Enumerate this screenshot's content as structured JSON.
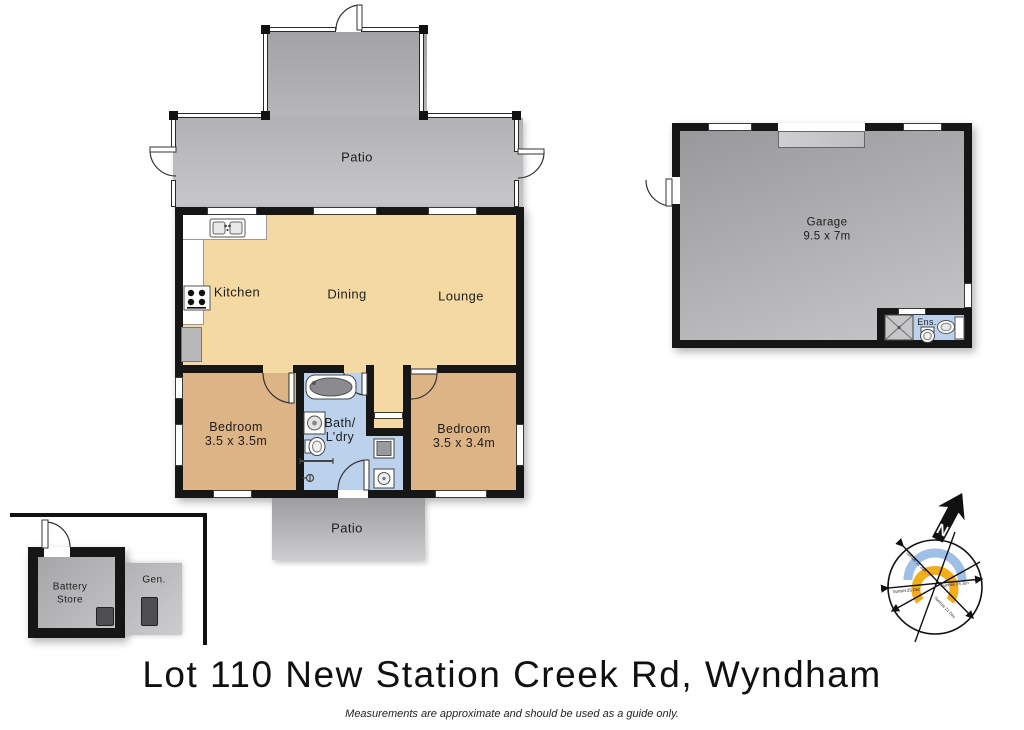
{
  "title": "Lot 110 New Station Creek Rd, Wyndham",
  "disclaimer": "Measurements are approximate and should be used as a guide only.",
  "house": {
    "patio_top": "Patio",
    "patio_bottom": "Patio",
    "kitchen": "Kitchen",
    "dining": "Dining",
    "lounge": "Lounge",
    "bedroom1_name": "Bedroom",
    "bedroom1_dims": "3.5 x 3.5m",
    "bedroom2_name": "Bedroom",
    "bedroom2_dims": "3.5 x 3.4m",
    "bath_line1": "Bath/",
    "bath_line2": "L’dry"
  },
  "garage": {
    "name": "Garage",
    "dims": "9.5 x 7m",
    "ensuite_label": "Ens."
  },
  "outbuildings": {
    "battery_store_line1": "Battery",
    "battery_store_line2": "Store",
    "generator_label": "Gen."
  },
  "compass": {
    "north_label": "N",
    "sunset_dec": "Sunset 25 Dec",
    "sunrise_jun": "Sunrise 25 Jun",
    "sunset_jun": "Sunset 21 Jun",
    "sunrise_dec": "Sunrise 21 Dec"
  },
  "colors": {
    "living": "#f5d9a3",
    "bedroom": "#dcb486",
    "bath_floor": "#bcd2ec",
    "wall": "#161616",
    "patio_gray_dark": "#9d9da0",
    "patio_gray_light": "#cdcdcf",
    "sun_ring_blue": "#9fc0e6",
    "sun_ring_orange": "#f2ac1c"
  }
}
